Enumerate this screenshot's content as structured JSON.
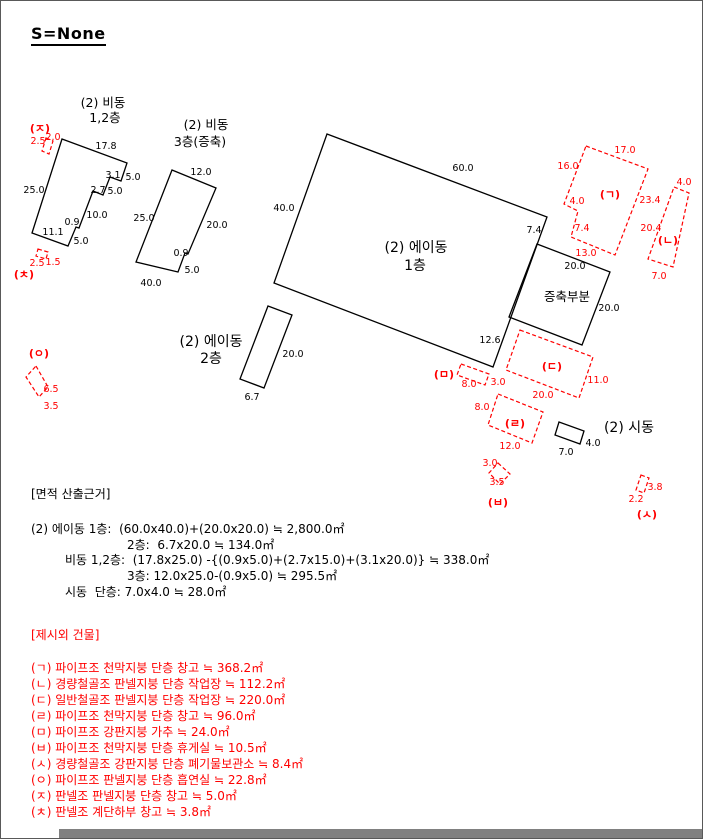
{
  "page": {
    "title": "S=None"
  },
  "colors": {
    "black": "#000000",
    "red": "#ff0000",
    "border": "#595959",
    "bottom_bar": "#808080"
  },
  "diagram": {
    "labels": [
      {
        "t": "17.8",
        "x": 105,
        "y": 148
      },
      {
        "t": "3.1",
        "x": 112,
        "y": 177
      },
      {
        "t": "5.0",
        "x": 132,
        "y": 179
      },
      {
        "t": "2.7",
        "x": 97,
        "y": 192
      },
      {
        "t": "5.0",
        "x": 114,
        "y": 193
      },
      {
        "t": "10.0",
        "x": 96,
        "y": 217
      },
      {
        "t": "0.9",
        "x": 71,
        "y": 224
      },
      {
        "t": "5.0",
        "x": 80,
        "y": 243
      },
      {
        "t": "11.1",
        "x": 52,
        "y": 234
      },
      {
        "t": "25.0",
        "x": 33,
        "y": 192
      },
      {
        "t": "12.0",
        "x": 200,
        "y": 174
      },
      {
        "t": "25.0",
        "x": 143,
        "y": 220
      },
      {
        "t": "20.0",
        "x": 216,
        "y": 227
      },
      {
        "t": "0.9",
        "x": 180,
        "y": 255
      },
      {
        "t": "5.0",
        "x": 191,
        "y": 272
      },
      {
        "t": "40.0",
        "x": 150,
        "y": 285
      },
      {
        "t": "60.0",
        "x": 462,
        "y": 170
      },
      {
        "t": "40.0",
        "x": 283,
        "y": 210
      },
      {
        "t": "7.4",
        "x": 533,
        "y": 232
      },
      {
        "t": "12.6",
        "x": 489,
        "y": 342
      },
      {
        "t": "20.0",
        "x": 574,
        "y": 268
      },
      {
        "t": "20.0",
        "x": 608,
        "y": 310
      },
      {
        "t": "20.0",
        "x": 292,
        "y": 356
      },
      {
        "t": "6.7",
        "x": 251,
        "y": 399
      },
      {
        "t": "7.0",
        "x": 565,
        "y": 454
      },
      {
        "t": "4.0",
        "x": 592,
        "y": 445
      },
      {
        "t": "(2) 비동",
        "x": 102,
        "y": 106,
        "fs": 12.5,
        "n": "building-title"
      },
      {
        "t": "1,2층",
        "x": 104,
        "y": 121,
        "fs": 12.5,
        "n": "building-title"
      },
      {
        "t": "(2) 비동",
        "x": 205,
        "y": 128,
        "fs": 12.5,
        "n": "building-title"
      },
      {
        "t": "3층(증축)",
        "x": 199,
        "y": 145,
        "fs": 12.5,
        "n": "building-title"
      },
      {
        "t": "(2) 에이동",
        "x": 415,
        "y": 251,
        "fs": 14,
        "n": "building-title"
      },
      {
        "t": "1층",
        "x": 414,
        "y": 269,
        "fs": 14,
        "n": "building-title"
      },
      {
        "t": "(2) 에이동",
        "x": 210,
        "y": 345,
        "fs": 14,
        "n": "building-title"
      },
      {
        "t": "2층",
        "x": 210,
        "y": 362,
        "fs": 14,
        "n": "building-title"
      },
      {
        "t": "(2) 시동",
        "x": 628,
        "y": 431,
        "fs": 14,
        "n": "building-title"
      },
      {
        "t": "증축부분",
        "x": 566,
        "y": 300,
        "fs": 12.5,
        "n": "building-title"
      },
      {
        "t": "(ㄱ)",
        "x": 609,
        "y": 197,
        "c": "r",
        "fs": 11,
        "b": true,
        "n": "annex-letter-label"
      },
      {
        "t": "(ㄴ)",
        "x": 667,
        "y": 243,
        "c": "r",
        "fs": 11,
        "b": true,
        "n": "annex-letter-label"
      },
      {
        "t": "(ㄷ)",
        "x": 551,
        "y": 369,
        "c": "r",
        "fs": 11,
        "b": true,
        "n": "annex-letter-label"
      },
      {
        "t": "(ㄹ)",
        "x": 514,
        "y": 426,
        "c": "r",
        "fs": 11,
        "b": true,
        "n": "annex-letter-label"
      },
      {
        "t": "(ㅁ)",
        "x": 443,
        "y": 377,
        "c": "r",
        "fs": 11,
        "b": true,
        "n": "annex-letter-label"
      },
      {
        "t": "(ㅂ)",
        "x": 497,
        "y": 505,
        "c": "r",
        "fs": 11,
        "b": true,
        "n": "annex-letter-label"
      },
      {
        "t": "(ㅅ)",
        "x": 646,
        "y": 517,
        "c": "r",
        "fs": 11,
        "b": true,
        "n": "annex-letter-label"
      },
      {
        "t": "(ㅇ)",
        "x": 38,
        "y": 356,
        "c": "r",
        "fs": 11,
        "b": true,
        "n": "annex-letter-label"
      },
      {
        "t": "(ㅈ)",
        "x": 39,
        "y": 131,
        "c": "r",
        "fs": 11,
        "b": true,
        "n": "annex-letter-label"
      },
      {
        "t": "(ㅊ)",
        "x": 23,
        "y": 277,
        "c": "r",
        "fs": 11,
        "b": true,
        "n": "annex-letter-label"
      },
      {
        "t": "2.5",
        "x": 37,
        "y": 143,
        "c": "r"
      },
      {
        "t": "2.0",
        "x": 52,
        "y": 139,
        "c": "r"
      },
      {
        "t": "2.5",
        "x": 36,
        "y": 265,
        "c": "r"
      },
      {
        "t": "1.5",
        "x": 52,
        "y": 264,
        "c": "r"
      },
      {
        "t": "6.5",
        "x": 50,
        "y": 391,
        "c": "r"
      },
      {
        "t": "3.5",
        "x": 50,
        "y": 408,
        "c": "r"
      },
      {
        "t": "17.0",
        "x": 624,
        "y": 152,
        "c": "r"
      },
      {
        "t": "16.0",
        "x": 567,
        "y": 168,
        "c": "r"
      },
      {
        "t": "4.0",
        "x": 576,
        "y": 203,
        "c": "r"
      },
      {
        "t": "7.4",
        "x": 581,
        "y": 230,
        "c": "r"
      },
      {
        "t": "13.0",
        "x": 585,
        "y": 255,
        "c": "r"
      },
      {
        "t": "23.4",
        "x": 649,
        "y": 202,
        "c": "r"
      },
      {
        "t": "4.0",
        "x": 683,
        "y": 184,
        "c": "r"
      },
      {
        "t": "20.4",
        "x": 650,
        "y": 230,
        "c": "r"
      },
      {
        "t": "7.0",
        "x": 658,
        "y": 278,
        "c": "r"
      },
      {
        "t": "11.0",
        "x": 597,
        "y": 382,
        "c": "r"
      },
      {
        "t": "20.0",
        "x": 542,
        "y": 397,
        "c": "r"
      },
      {
        "t": "8.0",
        "x": 468,
        "y": 386,
        "c": "r"
      },
      {
        "t": "3.0",
        "x": 497,
        "y": 384,
        "c": "r"
      },
      {
        "t": "8.0",
        "x": 481,
        "y": 409,
        "c": "r"
      },
      {
        "t": "12.0",
        "x": 509,
        "y": 448,
        "c": "r"
      },
      {
        "t": "3.0",
        "x": 489,
        "y": 465,
        "c": "r"
      },
      {
        "t": "3.5",
        "x": 496,
        "y": 484,
        "c": "r"
      },
      {
        "t": "3.8",
        "x": 654,
        "y": 489,
        "c": "r"
      },
      {
        "t": "2.2",
        "x": 635,
        "y": 501,
        "c": "r"
      }
    ]
  },
  "area_basis": {
    "header": "[면적 산출근거]",
    "lines": [
      {
        "indent": 0,
        "text": "(2) 에이동 1층:  (60.0x40.0)+(20.0x20.0) ≒ 2,800.0㎡"
      },
      {
        "indent": 2,
        "text": "2층:  6.7x20.0 ≒ 134.0㎡"
      },
      {
        "indent": 1,
        "text": "비동 1,2층:  (17.8x25.0) -{(0.9x5.0)+(2.7x15.0)+(3.1x20.0)} ≒ 338.0㎡"
      },
      {
        "indent": 2,
        "text": "3층: 12.0x25.0-(0.9x5.0) ≒ 295.5㎡"
      },
      {
        "indent": 1,
        "text": "시동  단층: 7.0x4.0 ≒ 28.0㎡"
      }
    ]
  },
  "external_buildings": {
    "header": "[제시외 건물]",
    "items": [
      "(ㄱ) 파이프조 천막지붕 단층 창고 ≒ 368.2㎡",
      "(ㄴ) 경량철골조 판넬지붕 단층 작업장 ≒ 112.2㎡",
      "(ㄷ) 일반철골조 판넬지붕 단층 작업장 ≒ 220.0㎡",
      "(ㄹ) 파이프조 천막지붕 단층 창고 ≒ 96.0㎡",
      "(ㅁ) 파이프조 강판지붕 가추 ≒ 24.0㎡",
      "(ㅂ) 파이프조 천막지붕 단층 휴게실 ≒ 10.5㎡",
      "(ㅅ) 경량철골조 강판지붕 단층 폐기물보관소 ≒ 8.4㎡",
      "(ㅇ) 파이프조 판넬지붕 단층 흡연실 ≒ 22.8㎡",
      "(ㅈ) 판넬조 판넬지붕 단층 창고 ≒ 5.0㎡",
      "(ㅊ) 판넬조 계단하부 창고 ≒ 3.8㎡"
    ]
  }
}
